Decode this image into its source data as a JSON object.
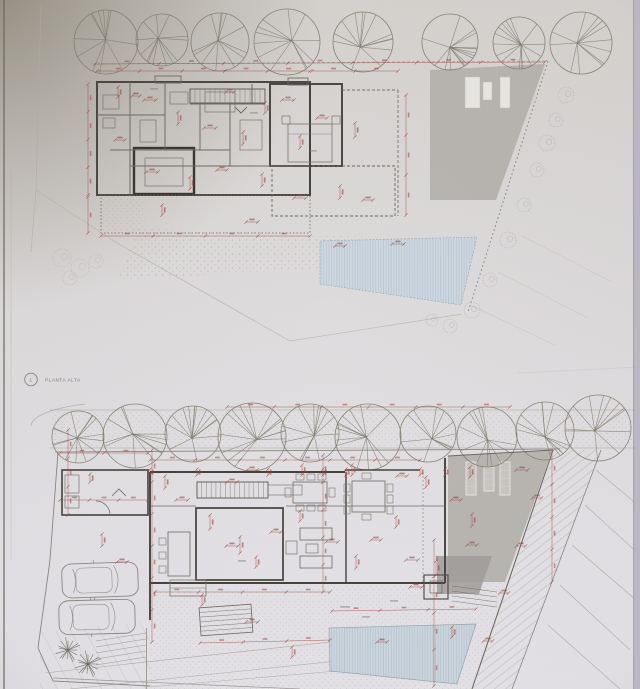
{
  "sheet": {
    "description": "Photographed architectural drawing sheet with two stacked floor plans of a villa",
    "upper_plan": {
      "marker": "1",
      "label": "PLANTA ALTA",
      "features": [
        "tree row",
        "roof with 3 skylights",
        "terrace",
        "pool",
        "site boundary with bushes"
      ]
    },
    "ground_plan": {
      "features": [
        "tree row",
        "garage with 2 cars",
        "central courtyard",
        "stairs",
        "kitchen island",
        "dining tables",
        "sofas",
        "gray deck with 3 sun loungers",
        "pool",
        "hatched sloped terrain"
      ]
    }
  },
  "colors": {
    "paper_top": "#d6d3d0",
    "paper_mid": "#dddadb",
    "paper_bottom": "#e6e4e9",
    "corner_shadow": "#6f6753",
    "wall": "#46433e",
    "line_medium": "#6f6b64",
    "line_faint": "#a39f94",
    "tree": "#7f7c6e",
    "dimension_red": "#9c4540",
    "pool_fill": "#cfd9e1",
    "pool_stripe": "#b9c6d2",
    "deck_gray": "#b6b3af",
    "deck_dark": "#a19e9b",
    "skylight": "#e9e7e4"
  }
}
